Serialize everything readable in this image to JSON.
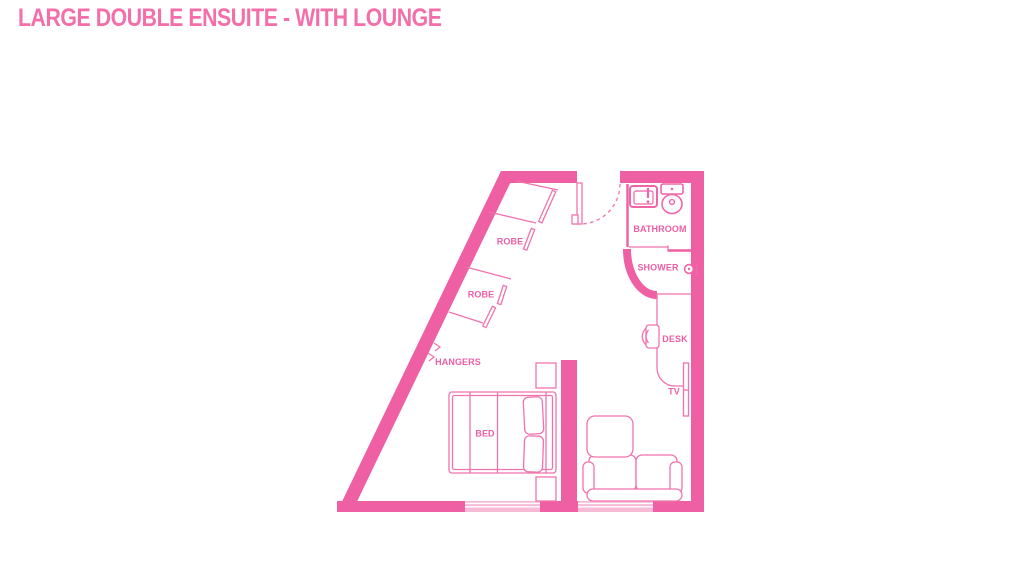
{
  "title": {
    "text": "LARGE DOUBLE ENSUITE - WITH LOUNGE",
    "color": "#f46fa9"
  },
  "floorplan": {
    "colors": {
      "wall": "#ee5fa4",
      "furniture": "#f173ae",
      "fixture": "#ef66a8",
      "window_glass": "#f6bad6",
      "label": "#ee5fa4"
    },
    "labels": {
      "robe_upper": "ROBE",
      "robe_lower": "ROBE",
      "hangers": "HANGERS",
      "bed": "BED",
      "bathroom": "BATHROOM",
      "shower": "SHOWER",
      "desk": "DESK",
      "tv": "TV"
    },
    "icons": [
      "sink-icon",
      "toilet-icon",
      "shower-head-icon",
      "door-swing",
      "hangers-icon",
      "desk-chair-icon",
      "tv-icon"
    ]
  }
}
